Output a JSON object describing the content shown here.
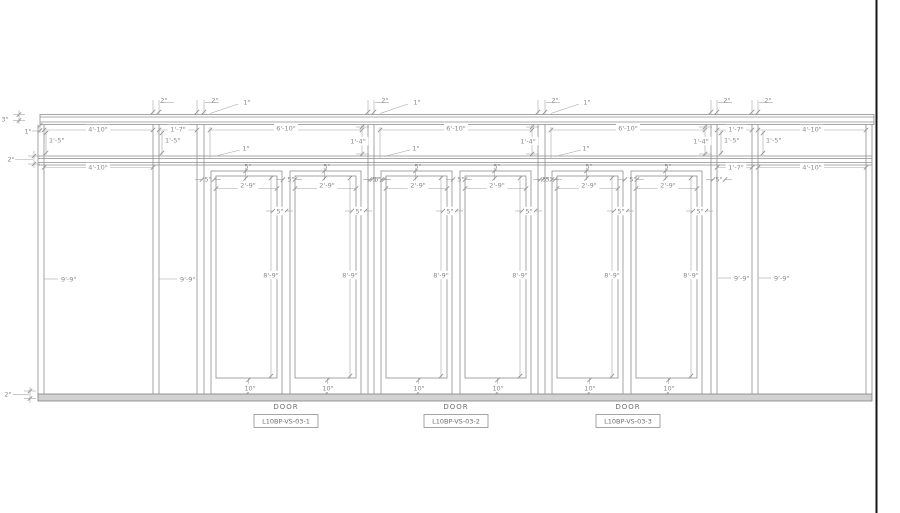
{
  "drawing": {
    "colors": {
      "background": "#ffffff",
      "frame_line": "#8f8f8f",
      "dim_line": "#a3a3a3",
      "text": "#8a8a8a",
      "sill_fill": "#d2d2d2",
      "sheet_border": "#161616"
    },
    "door_units": [
      {
        "label": "DOOR",
        "tag": "L10BP-VS-03-1",
        "cx": 286
      },
      {
        "label": "DOOR",
        "tag": "L10BP-VS-03-2",
        "cx": 456
      },
      {
        "label": "DOOR",
        "tag": "L10BP-VS-03-3",
        "cx": 628
      }
    ],
    "annotations": [
      {
        "t": "3\"",
        "x": 5,
        "y": 119
      },
      {
        "t": "1\"",
        "x": 28,
        "y": 131
      },
      {
        "t": "2\"",
        "x": 11,
        "y": 159
      },
      {
        "t": "2\"",
        "x": 8,
        "y": 394
      },
      {
        "t": "4'-10\"",
        "x": 98,
        "y": 129,
        "bg": 1
      },
      {
        "t": "1'-7\"",
        "x": 178,
        "y": 129,
        "bg": 1
      },
      {
        "t": "1'-7\"",
        "x": 736,
        "y": 129,
        "bg": 1
      },
      {
        "t": "4'-10\"",
        "x": 812,
        "y": 129,
        "bg": 1
      },
      {
        "t": "4'-10\"",
        "x": 98,
        "y": 167,
        "bg": 1
      },
      {
        "t": "1'-7\"",
        "x": 736,
        "y": 167,
        "bg": 1
      },
      {
        "t": "4'-10\"",
        "x": 812,
        "y": 167,
        "bg": 1
      },
      {
        "t": "1'-5\"",
        "x": 49,
        "y": 140,
        "a": "s"
      },
      {
        "t": "1'-5\"",
        "x": 165,
        "y": 140,
        "a": "s"
      },
      {
        "t": "1'-5\"",
        "x": 724,
        "y": 140,
        "a": "s"
      },
      {
        "t": "1'-5\"",
        "x": 766,
        "y": 140,
        "a": "s"
      },
      {
        "t": "9'-9\"",
        "x": 61,
        "y": 279,
        "a": "s"
      },
      {
        "t": "9'-9\"",
        "x": 180,
        "y": 279,
        "a": "s"
      },
      {
        "t": "9'-9\"",
        "x": 734,
        "y": 278,
        "a": "s"
      },
      {
        "t": "9'-9\"",
        "x": 774,
        "y": 278,
        "a": "s"
      },
      {
        "t": "2\"",
        "x": 164,
        "y": 100
      },
      {
        "t": "2\"",
        "x": 215,
        "y": 100
      },
      {
        "t": "2\"",
        "x": 385,
        "y": 100
      },
      {
        "t": "2\"",
        "x": 555,
        "y": 100
      },
      {
        "t": "2\"",
        "x": 727,
        "y": 100
      },
      {
        "t": "2\"",
        "x": 768,
        "y": 100
      },
      {
        "t": "1\"",
        "x": 247,
        "y": 102
      },
      {
        "t": "1\"",
        "x": 417,
        "y": 102
      },
      {
        "t": "1\"",
        "x": 587,
        "y": 102
      },
      {
        "t": "1\"",
        "x": 246,
        "y": 148
      },
      {
        "t": "1\"",
        "x": 416,
        "y": 148
      },
      {
        "t": "1\"",
        "x": 586,
        "y": 148
      },
      {
        "t": "6'-10\"",
        "x": 286,
        "y": 128,
        "bg": 1
      },
      {
        "t": "6'-10\"",
        "x": 456,
        "y": 128,
        "bg": 1
      },
      {
        "t": "6'-10\"",
        "x": 628,
        "y": 128,
        "bg": 1
      },
      {
        "t": "1'-4\"",
        "x": 358,
        "y": 141,
        "bg": 1
      },
      {
        "t": "1'-4\"",
        "x": 528,
        "y": 141,
        "bg": 1
      },
      {
        "t": "1'-4\"",
        "x": 701,
        "y": 141,
        "bg": 1
      },
      {
        "t": "5\"",
        "x": 248,
        "y": 166
      },
      {
        "t": "5\"",
        "x": 327,
        "y": 166
      },
      {
        "t": "5\"",
        "x": 418,
        "y": 166
      },
      {
        "t": "5\"",
        "x": 497,
        "y": 166
      },
      {
        "t": "5\"",
        "x": 589,
        "y": 166
      },
      {
        "t": "5\"",
        "x": 668,
        "y": 166
      },
      {
        "t": "5\"",
        "x": 208,
        "y": 179
      },
      {
        "t": "5\"",
        "x": 291,
        "y": 179
      },
      {
        "t": "5\"",
        "x": 376,
        "y": 179
      },
      {
        "t": "5\"",
        "x": 378,
        "y": 179
      },
      {
        "t": "5\"",
        "x": 461,
        "y": 179
      },
      {
        "t": "5\"",
        "x": 546,
        "y": 179
      },
      {
        "t": "5\"",
        "x": 549,
        "y": 179
      },
      {
        "t": "5\"",
        "x": 633,
        "y": 179
      },
      {
        "t": "5\"",
        "x": 719,
        "y": 179
      },
      {
        "t": "2'-9\"",
        "x": 248,
        "y": 185,
        "bg": 1
      },
      {
        "t": "2'-9\"",
        "x": 327,
        "y": 185,
        "bg": 1
      },
      {
        "t": "2'-9\"",
        "x": 418,
        "y": 185,
        "bg": 1
      },
      {
        "t": "2'-9\"",
        "x": 497,
        "y": 185,
        "bg": 1
      },
      {
        "t": "2'-9\"",
        "x": 589,
        "y": 185,
        "bg": 1
      },
      {
        "t": "2'-9\"",
        "x": 668,
        "y": 185,
        "bg": 1
      },
      {
        "t": "5\"",
        "x": 280,
        "y": 211,
        "bg": 1
      },
      {
        "t": "5\"",
        "x": 359,
        "y": 211,
        "bg": 1
      },
      {
        "t": "5\"",
        "x": 450,
        "y": 211,
        "bg": 1
      },
      {
        "t": "5\"",
        "x": 529,
        "y": 211,
        "bg": 1
      },
      {
        "t": "5\"",
        "x": 621,
        "y": 211,
        "bg": 1
      },
      {
        "t": "5\"",
        "x": 700,
        "y": 211,
        "bg": 1
      },
      {
        "t": "8'-9\"",
        "x": 271,
        "y": 275,
        "bg": 1
      },
      {
        "t": "8'-9\"",
        "x": 350,
        "y": 275,
        "bg": 1
      },
      {
        "t": "8'-9\"",
        "x": 441,
        "y": 275,
        "bg": 1
      },
      {
        "t": "8'-9\"",
        "x": 520,
        "y": 275,
        "bg": 1
      },
      {
        "t": "8'-9\"",
        "x": 612,
        "y": 275,
        "bg": 1
      },
      {
        "t": "8'-9\"",
        "x": 691,
        "y": 275,
        "bg": 1
      },
      {
        "t": "10\"",
        "x": 250,
        "y": 388,
        "bg": 1
      },
      {
        "t": "10\"",
        "x": 328,
        "y": 388,
        "bg": 1
      },
      {
        "t": "10\"",
        "x": 419,
        "y": 388,
        "bg": 1
      },
      {
        "t": "10\"",
        "x": 498,
        "y": 388,
        "bg": 1
      },
      {
        "t": "10\"",
        "x": 590,
        "y": 388,
        "bg": 1
      },
      {
        "t": "10\"",
        "x": 669,
        "y": 388,
        "bg": 1
      }
    ]
  }
}
